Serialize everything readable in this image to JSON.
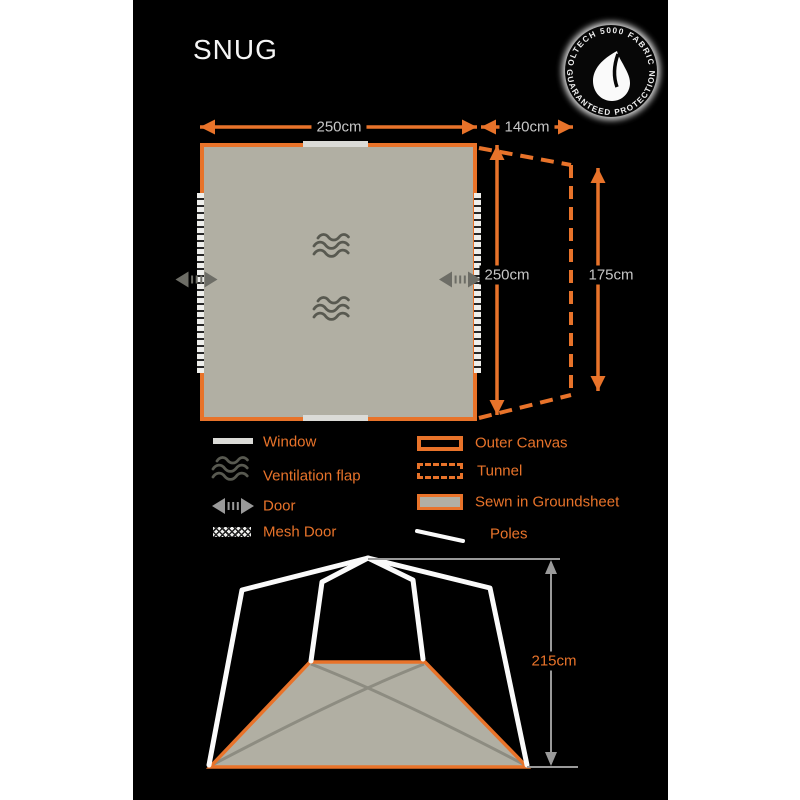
{
  "title": "SNUG",
  "badge": {
    "arc_top": "OLTECH 5000 FABRIC",
    "arc_bottom": "GUARANTEED PROTECTION"
  },
  "floor_plan": {
    "width": "250cm",
    "tunnel_depth": "140cm",
    "depth": "250cm",
    "tunnel_end_height": "175cm"
  },
  "front_view": {
    "height": "215cm"
  },
  "legend_left": [
    {
      "key": "window",
      "label": "Window"
    },
    {
      "key": "ventilation-flap",
      "label": "Ventilation flap"
    },
    {
      "key": "door",
      "label": "Door"
    },
    {
      "key": "mesh-door",
      "label": "Mesh Door"
    }
  ],
  "legend_right": [
    {
      "key": "outer-canvas",
      "label": "Outer Canvas"
    },
    {
      "key": "tunnel",
      "label": "Tunnel"
    },
    {
      "key": "sewn-in-groundsheet",
      "label": "Sewn in Groundsheet"
    },
    {
      "key": "poles",
      "label": "Poles"
    }
  ],
  "colors": {
    "accent_orange": "#e8732a",
    "groundsheet_gray": "#b1afa3",
    "dim_text_gray": "#c6c6c6",
    "symbol_gray": "#585950",
    "pole_white": "#fafafa"
  }
}
